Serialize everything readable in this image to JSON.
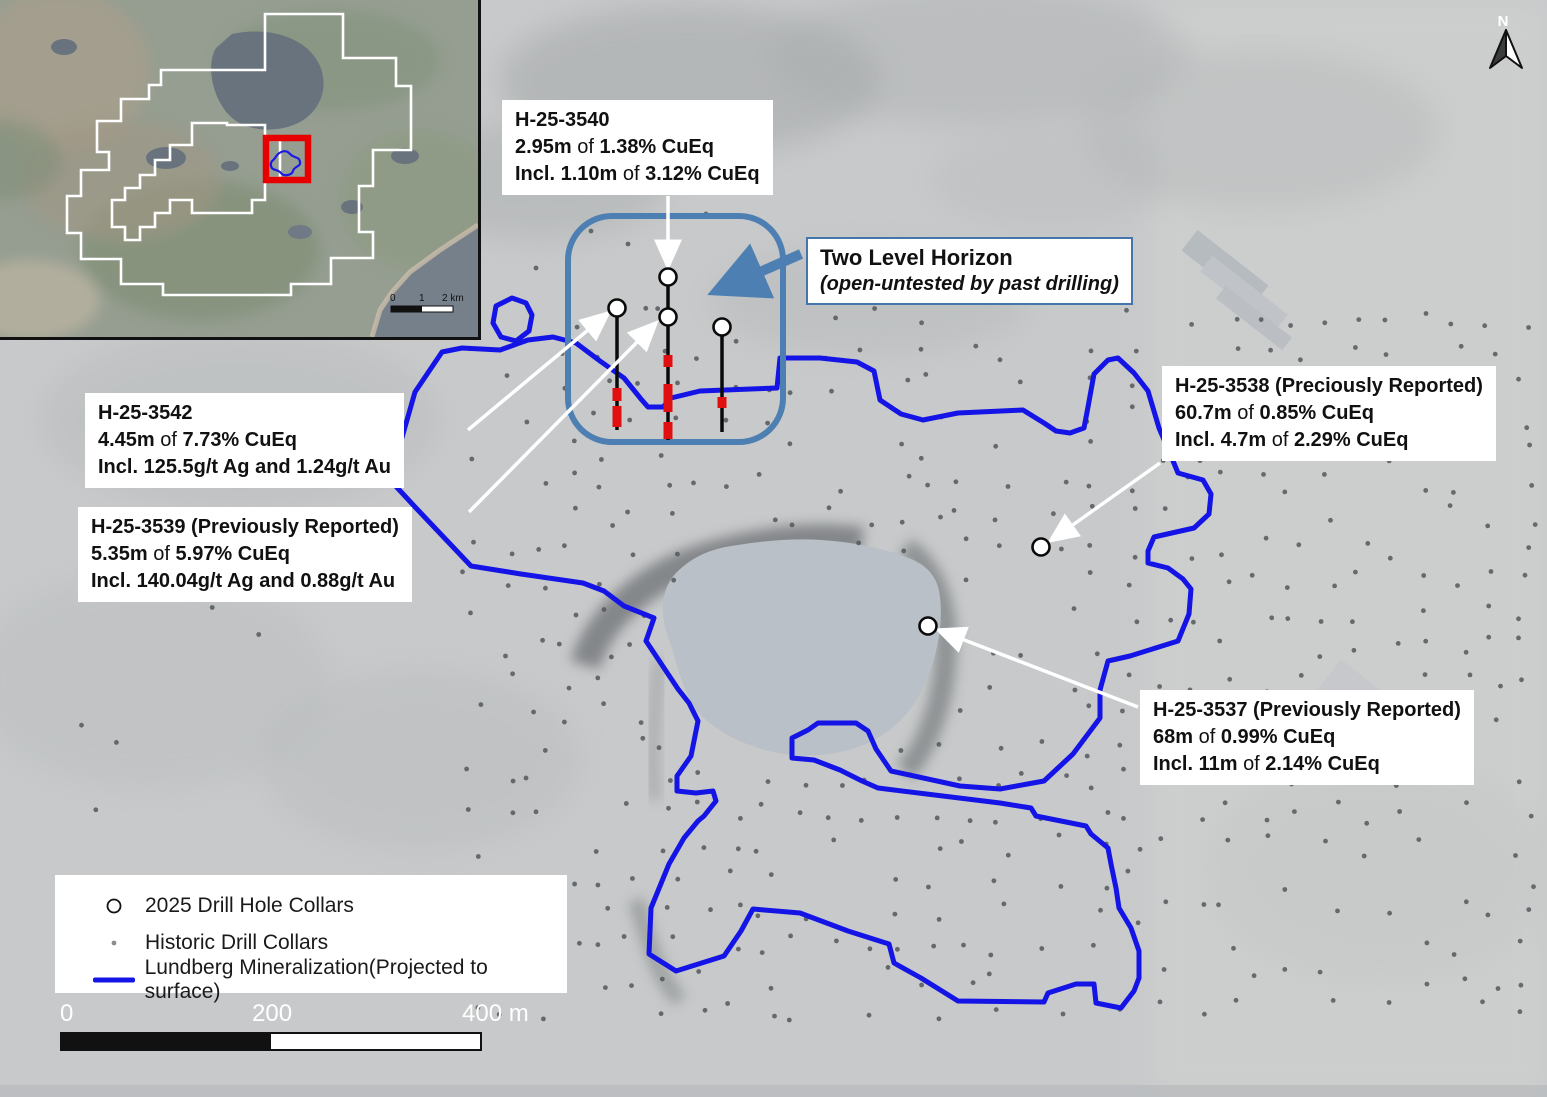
{
  "page": {
    "width": 1547,
    "height": 1097
  },
  "colors": {
    "mineralization_blue": "#1414e6",
    "drill_box_blue": "#4d7fb2",
    "horizon_border_blue": "#4576ab",
    "intercept_red": "#e01010",
    "inset_highlight_red": "#e60000",
    "claim_outline_white": "#ffffff",
    "historic_dot_gray": "#54585a",
    "lake_gray_blue": "#b9c0c7"
  },
  "north_arrow": {
    "label": "N"
  },
  "callouts": {
    "h3540": {
      "lines": [
        "H-25-3540",
        "2.95m of 1.38% CuEq",
        "Incl. 1.10m of 3.12% CuEq"
      ]
    },
    "h3542": {
      "lines": [
        "H-25-3542",
        "4.45m of 7.73% CuEq",
        "Incl. 125.5g/t Ag and 1.24g/t Au"
      ]
    },
    "h3539": {
      "lines": [
        "H-25-3539 (Previously Reported)",
        "5.35m of 5.97% CuEq",
        "Incl. 140.04g/t Ag and 0.88g/t Au"
      ]
    },
    "h3538": {
      "lines": [
        "H-25-3538 (Preciously Reported)",
        "60.7m of 0.85% CuEq",
        "Incl. 4.7m of 2.29% CuEq"
      ]
    },
    "h3537": {
      "lines": [
        "H-25-3537 (Previously Reported)",
        "68m of 0.99% CuEq",
        "Incl. 11m of 2.14% CuEq"
      ]
    }
  },
  "horizon_note": {
    "title": "Two Level Horizon",
    "subtitle": "(open-untested by past drilling)"
  },
  "legend": {
    "items": [
      {
        "symbol": "collar-2025",
        "label": "2025 Drill Hole Collars"
      },
      {
        "symbol": "collar-historic",
        "label": "Historic Drill Collars"
      },
      {
        "symbol": "mineralization-line",
        "label": "Lundberg Mineralization(Projected to surface)"
      }
    ]
  },
  "scalebar": {
    "labels": [
      "0",
      "200",
      "400 m"
    ]
  },
  "inset_map": {
    "scalebar_labels": [
      "0",
      "1",
      "2 km"
    ]
  },
  "map_data": {
    "drill_area_box": {
      "x": 568,
      "y": 216,
      "w": 215,
      "h": 226,
      "r": 44
    },
    "collars_2025": [
      [
        617,
        308
      ],
      [
        668,
        277
      ],
      [
        668,
        317
      ],
      [
        722,
        327
      ],
      [
        1041,
        547
      ],
      [
        928,
        626
      ]
    ],
    "drill_traces": [
      {
        "x": 617,
        "y1": 316,
        "y2": 430,
        "intervals": [
          [
            388,
            401
          ],
          [
            406,
            427
          ]
        ]
      },
      {
        "x": 668,
        "y1": 285,
        "y2": 440,
        "intervals": [
          [
            355,
            367
          ],
          [
            384,
            412
          ],
          [
            422,
            439
          ]
        ]
      },
      {
        "x": 722,
        "y1": 335,
        "y2": 432,
        "intervals": [
          [
            397,
            408
          ]
        ]
      }
    ],
    "leader_arrows": [
      {
        "from": [
          668,
          196
        ],
        "to": [
          668,
          264
        ]
      },
      {
        "from": [
          468,
          430
        ],
        "to": [
          606,
          315
        ]
      },
      {
        "from": [
          469,
          512
        ],
        "to": [
          654,
          325
        ]
      },
      {
        "from": [
          1160,
          463
        ],
        "to": [
          1053,
          539
        ]
      },
      {
        "from": [
          1138,
          707
        ],
        "to": [
          941,
          631
        ]
      }
    ],
    "horizon_arrow": {
      "from": [
        801,
        254
      ],
      "to": [
        721,
        289
      ]
    },
    "mineralization": {
      "outline": [
        [
          415,
          392
        ],
        [
          442,
          352
        ],
        [
          462,
          348
        ],
        [
          500,
          350
        ],
        [
          528,
          340
        ],
        [
          553,
          337
        ],
        [
          576,
          343
        ],
        [
          600,
          361
        ],
        [
          624,
          378
        ],
        [
          641,
          399
        ],
        [
          648,
          407
        ],
        [
          663,
          407
        ],
        [
          671,
          398
        ],
        [
          700,
          391
        ],
        [
          777,
          388
        ],
        [
          780,
          358
        ],
        [
          820,
          358
        ],
        [
          857,
          362
        ],
        [
          874,
          371
        ],
        [
          880,
          400
        ],
        [
          901,
          414
        ],
        [
          923,
          420
        ],
        [
          958,
          413
        ],
        [
          1023,
          410
        ],
        [
          1044,
          423
        ],
        [
          1056,
          431
        ],
        [
          1070,
          433
        ],
        [
          1084,
          428
        ],
        [
          1088,
          407
        ],
        [
          1094,
          374
        ],
        [
          1108,
          360
        ],
        [
          1118,
          358
        ],
        [
          1134,
          373
        ],
        [
          1148,
          391
        ],
        [
          1159,
          428
        ],
        [
          1171,
          456
        ],
        [
          1178,
          473
        ],
        [
          1203,
          480
        ],
        [
          1211,
          494
        ],
        [
          1209,
          514
        ],
        [
          1194,
          528
        ],
        [
          1154,
          537
        ],
        [
          1148,
          551
        ],
        [
          1148,
          563
        ],
        [
          1168,
          568
        ],
        [
          1183,
          579
        ],
        [
          1191,
          589
        ],
        [
          1189,
          614
        ],
        [
          1178,
          641
        ],
        [
          1130,
          656
        ],
        [
          1108,
          661
        ],
        [
          1100,
          690
        ],
        [
          1100,
          718
        ],
        [
          1073,
          754
        ],
        [
          1044,
          781
        ],
        [
          1000,
          789
        ],
        [
          960,
          786
        ],
        [
          891,
          771
        ],
        [
          876,
          749
        ],
        [
          868,
          731
        ],
        [
          856,
          723
        ],
        [
          818,
          723
        ],
        [
          808,
          730
        ],
        [
          792,
          738
        ],
        [
          792,
          758
        ],
        [
          814,
          760
        ],
        [
          840,
          770
        ],
        [
          862,
          781
        ],
        [
          878,
          788
        ],
        [
          1000,
          803
        ],
        [
          1031,
          808
        ],
        [
          1036,
          816
        ],
        [
          1086,
          826
        ],
        [
          1091,
          834
        ],
        [
          1108,
          848
        ],
        [
          1111,
          864
        ],
        [
          1116,
          888
        ],
        [
          1119,
          908
        ],
        [
          1131,
          928
        ],
        [
          1139,
          951
        ],
        [
          1139,
          978
        ],
        [
          1134,
          991
        ],
        [
          1121,
          1008
        ],
        [
          1096,
          1003
        ],
        [
          1094,
          984
        ],
        [
          1076,
          984
        ],
        [
          1048,
          993
        ],
        [
          1044,
          1002
        ],
        [
          958,
          1001
        ],
        [
          921,
          978
        ],
        [
          894,
          963
        ],
        [
          889,
          944
        ],
        [
          848,
          931
        ],
        [
          800,
          913
        ],
        [
          753,
          909
        ],
        [
          741,
          931
        ],
        [
          724,
          956
        ],
        [
          676,
          971
        ],
        [
          649,
          954
        ],
        [
          651,
          908
        ],
        [
          669,
          864
        ],
        [
          684,
          838
        ],
        [
          698,
          821
        ],
        [
          704,
          816
        ],
        [
          716,
          801
        ],
        [
          713,
          791
        ],
        [
          696,
          793
        ],
        [
          677,
          791
        ],
        [
          677,
          776
        ],
        [
          691,
          756
        ],
        [
          698,
          721
        ],
        [
          689,
          703
        ],
        [
          678,
          689
        ],
        [
          646,
          641
        ],
        [
          654,
          618
        ],
        [
          624,
          606
        ],
        [
          604,
          591
        ],
        [
          583,
          583
        ],
        [
          521,
          574
        ],
        [
          471,
          566
        ],
        [
          416,
          508
        ],
        [
          391,
          481
        ],
        [
          401,
          441
        ]
      ],
      "loop": [
        [
          512,
          298
        ],
        [
          526,
          303
        ],
        [
          532,
          315
        ],
        [
          529,
          331
        ],
        [
          516,
          341
        ],
        [
          501,
          337
        ],
        [
          493,
          323
        ],
        [
          496,
          306
        ]
      ]
    },
    "historic_dots": {
      "seed": 7,
      "grid": {
        "x0": 470,
        "x1": 1535,
        "y0": 318,
        "y1": 1015,
        "step": 33,
        "jitter": 11,
        "keep": 0.62
      },
      "sparse_left": {
        "x0": 80,
        "x1": 460,
        "y0": 600,
        "y1": 1010,
        "step": 44,
        "jitter": 16,
        "keep": 0.12
      },
      "extra": [
        [
          591,
          231
        ],
        [
          706,
          214
        ],
        [
          748,
          262
        ],
        [
          536,
          268
        ],
        [
          628,
          244
        ]
      ],
      "radius": 2.4
    }
  }
}
